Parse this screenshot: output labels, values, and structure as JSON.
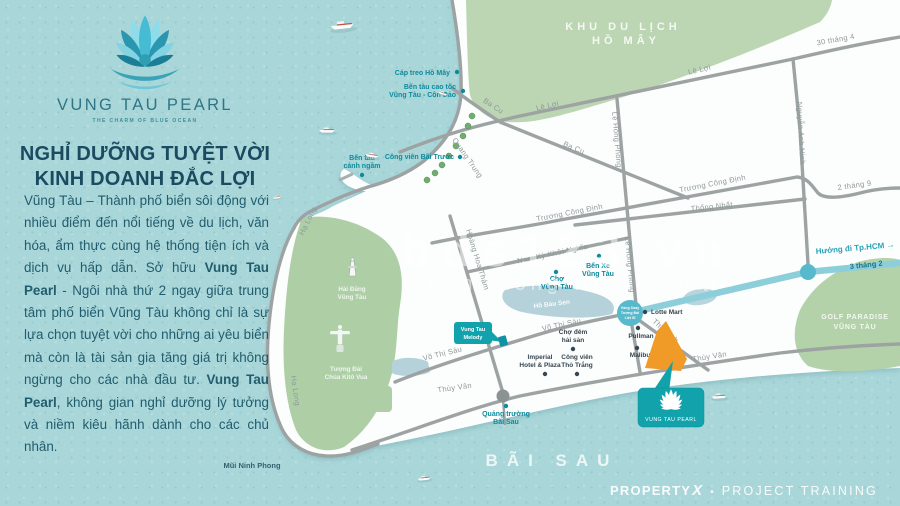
{
  "brand": {
    "wordmark": "VUNG TAU PEARL",
    "tagline": "THE CHARM OF BLUE OCEAN"
  },
  "panel": {
    "heading1": "NGHỈ DƯỠNG TUYỆT VỜI",
    "heading2": "KINH DOANH ĐẮC LỢI",
    "body_1": "Vũng Tàu – Thành phố biển sôi động với nhiều điểm đến nổi tiếng về du lịch, văn hóa, ẩm thực cùng hệ thống tiện ích và dịch vụ hấp dẫn. Sở hữu ",
    "body_bold_1": "Vung Tau Pearl",
    "body_2": " - Ngôi nhà thứ 2 ngay giữa trung tâm phố biển Vũng Tàu không chỉ là sự lựa chọn tuyệt vời cho những ai yêu biển mà còn là tài sản gia tăng giá trị không ngừng cho các nhà đầu tư. ",
    "body_bold_2": "Vung Tau Pearl",
    "body_3": ", không gian nghỉ dưỡng lý tưởng và niềm kiêu hãnh dành cho các chủ nhân."
  },
  "areas": {
    "ho_may_1": "KHU DU LỊCH",
    "ho_may_2": "HỒ MÂY",
    "golf_1": "GOLF PARADISE",
    "golf_2": "VŨNG TÀU",
    "bai_sau": "BÃI SAU",
    "mui_nghinh_phong": "Mũi Ninh Phong"
  },
  "streets": {
    "le_loi": "Lê Lợi",
    "thang4_30": "30 tháng 4",
    "ba_cu": "Ba Cu",
    "nguyen_anh_ninh": "Nguyễn Anh Ninh",
    "truong_cong_dinh": "Trương Công Định",
    "thong_nhat": "Thống Nhất",
    "thang9_2": "2 tháng 9",
    "le_hong_phong": "Lê Hồng Phong",
    "quang_trung": "Quang Trung",
    "ha_long": "Hạ Long",
    "hoang_hoa_tham": "Hoàng Hoa Thám",
    "nam_ky_khoi_nghia": "Nam Kỳ Khởi Nghĩa",
    "vo_thi_sau": "Võ Thị Sáu",
    "thuy_van": "Thùy Vân",
    "thi_sach": "Thi Sách",
    "thang2_3": "3 Tháng 2",
    "thang2_3_b": "3 tháng 2",
    "huong_di_hcm": "Hướng đi Tp.HCM →"
  },
  "landmarks": {
    "cap_treo": "Cáp treo Hồ Mây",
    "ben_tau_cao_toc_1": "Bến tàu cao tốc",
    "ben_tau_cao_toc_2": "Vũng Tàu - Côn Đảo",
    "ben_tau_canh_ngam_1": "Bến tàu",
    "ben_tau_canh_ngam_2": "cánh ngầm",
    "cong_vien_bai_truoc": "Công viên Bãi Trước",
    "hai_dang_1": "Hải Đăng",
    "hai_dang_2": "Vũng Tàu",
    "tuong_dai_1": "Tượng Đài",
    "tuong_dai_2": "Chúa Kitô Vua",
    "ben_xe_1": "Bến Xe",
    "ben_xe_2": "Vũng Tàu",
    "cho_vt_1": "Chợ",
    "cho_vt_2": "Vũng Tàu",
    "ho_bau_sen": "Hồ Bàu Sen",
    "lotte": "Lotte Mart",
    "pullman": "Pullman",
    "malibu": "Malibu",
    "cho_dem_1": "Chợ đêm",
    "cho_dem_2": "hải sản",
    "tho_trang_1": "Công viên",
    "tho_trang_2": "Thỏ Trắng",
    "imperial_1": "Imperial",
    "imperial_2": "Hotel & Plaza",
    "quang_truong_1": "Quảng trường",
    "quang_truong_2": "Bãi Sau",
    "melody_1": "Vung Tau",
    "melody_2": "Melody",
    "roundabout_1": "Vòng Xoay",
    "roundabout_2": "Tượng Đài",
    "roundabout_3": "Liệt Sĩ"
  },
  "marker": {
    "name": "VUNG TAU PEARL"
  },
  "watermark": {
    "line1": "bds123.vn",
    "line2": "kênh thông tin nhà đất"
  },
  "footer": {
    "brand": "PROPERTY",
    "brand_x": "X",
    "separator": "•",
    "label": "PROJECT TRAINING"
  },
  "colors": {
    "accent_teal": "#12a2ac",
    "site_orange": "#f09a28",
    "sea": "#a9d6d9",
    "park_green": "#bcd5b2",
    "road_gray": "#9da3a3",
    "label_teal": "#0d8b9d",
    "text_dark_teal": "#215d6e"
  }
}
